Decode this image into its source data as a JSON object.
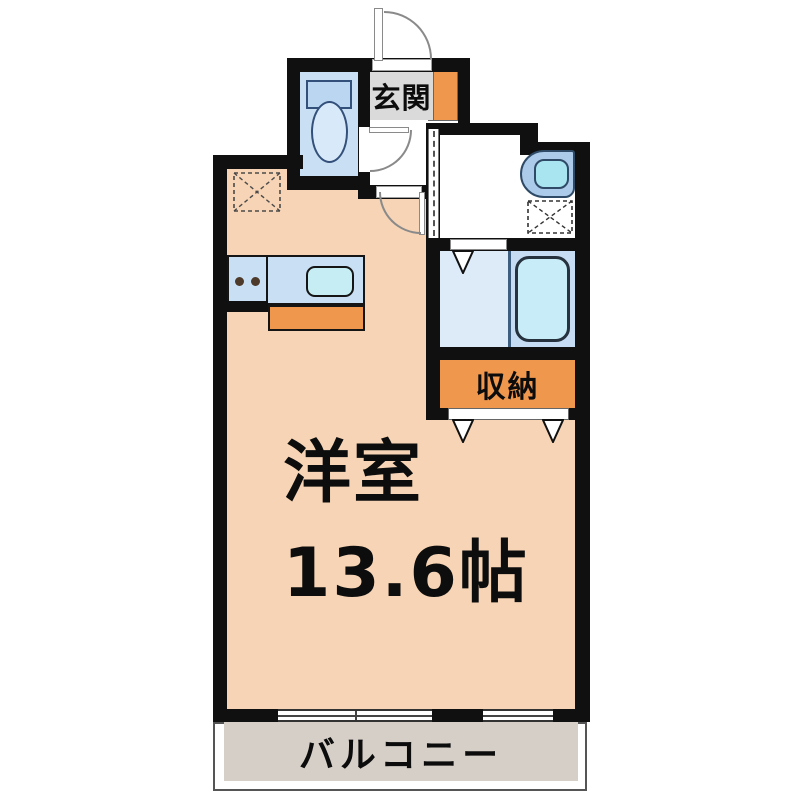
{
  "floorplan": {
    "kind": "apartment-floor-plan",
    "labels": {
      "entrance": "玄関",
      "main_room_line1": "洋室",
      "main_room_line2": "13.6帖",
      "storage": "収納",
      "balcony": "バルコニー"
    },
    "rooms": [
      {
        "name": "entrance",
        "label": "玄関"
      },
      {
        "name": "main-room",
        "label": "洋室 13.6帖",
        "size_jo": 13.6
      },
      {
        "name": "storage",
        "label": "収納"
      },
      {
        "name": "balcony",
        "label": "バルコニー"
      }
    ],
    "fixtures": [
      "toilet",
      "two-burner-stove",
      "kitchen-sink",
      "shoe-cabinet",
      "washbasin",
      "bathtub",
      "washing-machine-space",
      "refrigerator-space"
    ],
    "colors": {
      "wall": "#101010",
      "main_room": "#F6D4B5",
      "accent_orange": "#F0974E",
      "entrance_gray": "#DADADA",
      "fixture_blue": "#C9DFF3",
      "sink_cyan": "#C5EDF3",
      "bath_floor": "#DDEAF7",
      "tub_fill": "#C9EDF8",
      "balcony": "#D6CFC8"
    }
  }
}
